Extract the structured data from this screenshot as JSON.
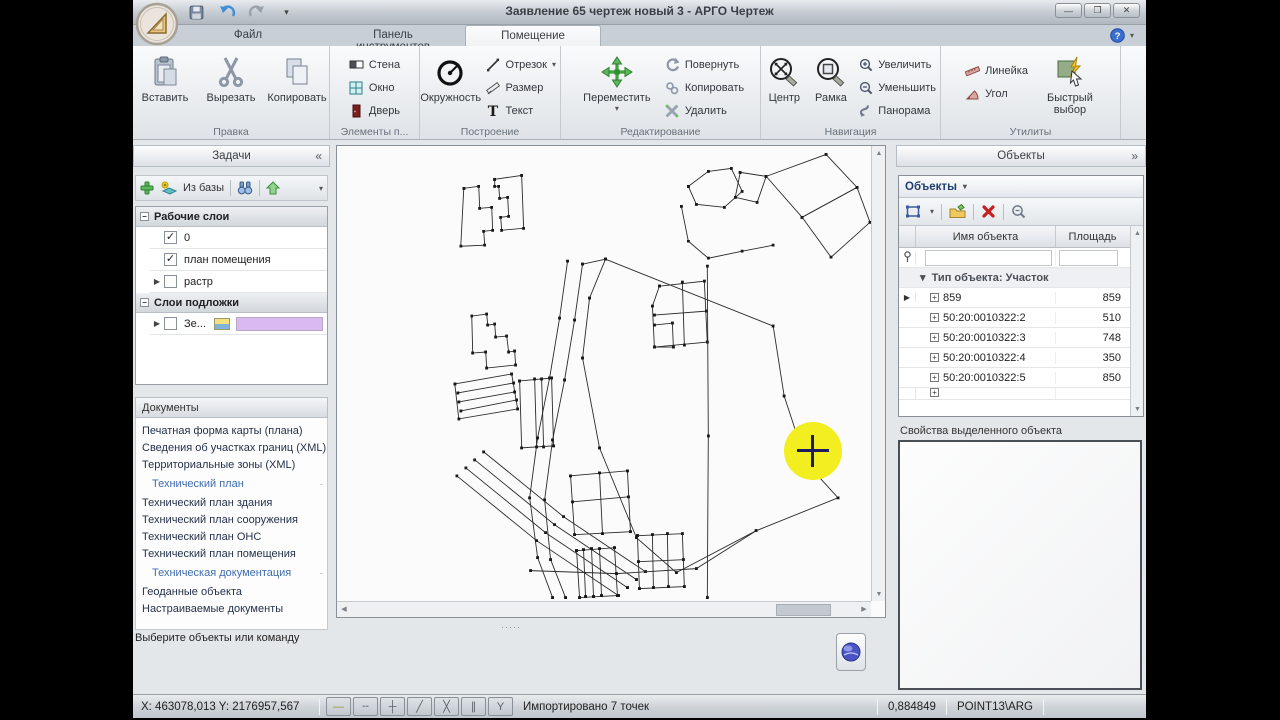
{
  "window": {
    "title": "Заявление 65 чертеж новый 3 - АРГО Чертеж"
  },
  "glyphs": {
    "caret_down": "▾",
    "collapse_left": "«",
    "expand_right": "»",
    "minimize": "—",
    "restore": "❐",
    "close": "✕",
    "check": "✓",
    "expand_row": "▸",
    "selected_marker": "▶",
    "group_caret": "▾",
    "scroll_up": "▲",
    "scroll_down": "▼",
    "scroll_left": "◀",
    "scroll_right": "▶",
    "minus_box": "−",
    "plus": "+",
    "dots": "·····"
  },
  "tabs": [
    {
      "label": "Файл"
    },
    {
      "label": "Панель инструментов"
    },
    {
      "label": "Помещение"
    }
  ],
  "ribbon": {
    "paste": "Вставить",
    "cut": "Вырезать",
    "copy": "Копировать",
    "group_edit": "Правка",
    "wall": "Стена",
    "window": "Окно",
    "door": "Дверь",
    "group_elements": "Элементы п...",
    "circle": "Окружность",
    "segment": "Отрезок",
    "dimension": "Размер",
    "text": "Текст",
    "group_build": "Построение",
    "move": "Переместить",
    "rotate": "Повернуть",
    "copy2": "Копировать",
    "del": "Удалить",
    "group_editops": "Редактирование",
    "center": "Центр",
    "frame": "Рамка",
    "zoom_in": "Увеличить",
    "zoom_out": "Уменьшить",
    "pan": "Панорама",
    "group_nav": "Навигация",
    "ruler": "Линейка",
    "angle": "Угол",
    "quick_select": "Быстрый выбор",
    "group_utils": "Утилиты"
  },
  "tasks": {
    "title": "Задачи",
    "from_base": "Из базы",
    "working_title": "Рабочие слои",
    "underlay_title": "Слои подложки",
    "layers": {
      "working": [
        {
          "name": "0",
          "checked": true
        },
        {
          "name": "план помещения",
          "checked": true
        },
        {
          "name": "растр",
          "checked": false,
          "expand": true
        }
      ],
      "underlay": [
        {
          "name": "Зе...",
          "checked": false,
          "expand": true,
          "icon": true,
          "swatch": "#d9b9ef"
        }
      ]
    },
    "documents_title": "Документы",
    "documents": [
      {
        "type": "item",
        "label": "Печатная форма карты (плана)"
      },
      {
        "type": "item",
        "label": "Сведения об участках границ (XML)"
      },
      {
        "type": "item",
        "label": "Территориальные зоны (XML)"
      },
      {
        "type": "header",
        "label": "Технический план"
      },
      {
        "type": "item",
        "label": "Технический план здания"
      },
      {
        "type": "item",
        "label": "Технический план сооружения"
      },
      {
        "type": "item",
        "label": "Технический план ОНС"
      },
      {
        "type": "item",
        "label": "Технический план помещения"
      },
      {
        "type": "header",
        "label": "Техническая документация"
      },
      {
        "type": "item",
        "label": "Геоданные объекта"
      },
      {
        "type": "item",
        "label": "Настраиваемые документы"
      }
    ],
    "hint": "Выберите объекты или команду"
  },
  "objects": {
    "panel_title": "Объекты",
    "dropdown_title": "Объекты",
    "col_name": "Имя объекта",
    "col_area": "Площадь",
    "group": "Тип объекта: Участок",
    "rows": [
      {
        "name": "859",
        "area": "859",
        "selected": true
      },
      {
        "name": "50:20:0010322:2",
        "area": "510"
      },
      {
        "name": "50:20:0010322:3",
        "area": "748"
      },
      {
        "name": "50:20:0010322:4",
        "area": "350"
      },
      {
        "name": "50:20:0010322:5",
        "area": "850"
      }
    ],
    "properties_title": "Свойства выделенного объекта"
  },
  "statusbar": {
    "coords": "X: 463078,013 Y: 2176957,567",
    "message": "Импортировано 7 точек",
    "value": "0,884849",
    "mode": "POINT13\\ARG",
    "snap": [
      {
        "g": "—",
        "c": "#9a9a28"
      },
      {
        "g": "╌"
      },
      {
        "g": "┼"
      },
      {
        "g": "╱"
      },
      {
        "g": "╳"
      },
      {
        "g": "∥"
      },
      {
        "g": "Y"
      }
    ]
  },
  "colors": {
    "highlight": "#f2ee20",
    "underlay_swatch": "#d9b9ef"
  },
  "canvas": {
    "polylines": [
      [
        127,
        42,
        142,
        40,
        143,
        62,
        155,
        61,
        156,
        84,
        147,
        85,
        148,
        99,
        124,
        100,
        127,
        42
      ],
      [
        158,
        33,
        185,
        29,
        187,
        82,
        165,
        84,
        164,
        71,
        172,
        70,
        171,
        51,
        163,
        52,
        162,
        40,
        158,
        40,
        158,
        33
      ],
      [
        135,
        170,
        150,
        168,
        151,
        179,
        158,
        178,
        159,
        191,
        170,
        190,
        172,
        206,
        178,
        205,
        179,
        219,
        150,
        222,
        149,
        206,
        136,
        207,
        135,
        170
      ],
      [
        118,
        238,
        175,
        228,
        181,
        263,
        122,
        273,
        118,
        238
      ],
      [
        121,
        247,
        177,
        237
      ],
      [
        122,
        256,
        178,
        246
      ],
      [
        124,
        265,
        180,
        254
      ],
      [
        269,
        113,
        437,
        180,
        448,
        250,
        470,
        317,
        502,
        352,
        420,
        385,
        340,
        427,
        300,
        392,
        263,
        302,
        246,
        212,
        253,
        152,
        269,
        113
      ],
      [
        231,
        115,
        223,
        172,
        213,
        232,
        201,
        292,
        193,
        352,
        201,
        412,
        216,
        452
      ],
      [
        246,
        118,
        238,
        174,
        228,
        234,
        216,
        294,
        208,
        354,
        214,
        414,
        229,
        452
      ],
      [
        120,
        330,
        200,
        395,
        282,
        450
      ],
      [
        129,
        322,
        209,
        387,
        291,
        442
      ],
      [
        138,
        314,
        218,
        379,
        300,
        434
      ],
      [
        147,
        306,
        227,
        371,
        309,
        426
      ],
      [
        352,
        40,
        372,
        25,
        395,
        22,
        406,
        45,
        388,
        61,
        360,
        58,
        352,
        40
      ],
      [
        430,
        30,
        490,
        8,
        521,
        41,
        466,
        71,
        430,
        30
      ],
      [
        466,
        71,
        521,
        41,
        534,
        76,
        495,
        111,
        466,
        71
      ],
      [
        404,
        26,
        430,
        30,
        421,
        56,
        399,
        51,
        404,
        26
      ],
      [
        345,
        60,
        352,
        95,
        372,
        112,
        406,
        105,
        437,
        99
      ],
      [
        323,
        140,
        368,
        135,
        371,
        196,
        318,
        201,
        316,
        160,
        323,
        140
      ],
      [
        318,
        169,
        370,
        165
      ],
      [
        346,
        136,
        348,
        199
      ],
      [
        318,
        179,
        336,
        177,
        337,
        201,
        318,
        201
      ],
      [
        234,
        330,
        291,
        325,
        294,
        386,
        238,
        389,
        234,
        330
      ],
      [
        236,
        356,
        292,
        351
      ],
      [
        263,
        327,
        266,
        388
      ],
      [
        301,
        390,
        346,
        388,
        348,
        441,
        303,
        443,
        301,
        390
      ],
      [
        316,
        389,
        317,
        442
      ],
      [
        331,
        388,
        332,
        441
      ],
      [
        302,
        416,
        347,
        414
      ],
      [
        240,
        405,
        278,
        402,
        281,
        450,
        243,
        452,
        240,
        405
      ],
      [
        247,
        404,
        249,
        451
      ],
      [
        255,
        403,
        257,
        451
      ],
      [
        263,
        403,
        265,
        450
      ],
      [
        183,
        235,
        215,
        232,
        217,
        300,
        185,
        302,
        183,
        235
      ],
      [
        198,
        233,
        200,
        301
      ],
      [
        205,
        233,
        207,
        301
      ],
      [
        371,
        120,
        372,
        290,
        371,
        452
      ],
      [
        269,
        113,
        246,
        118
      ],
      [
        194,
        425,
        280,
        428,
        360,
        423,
        420,
        385
      ]
    ]
  }
}
